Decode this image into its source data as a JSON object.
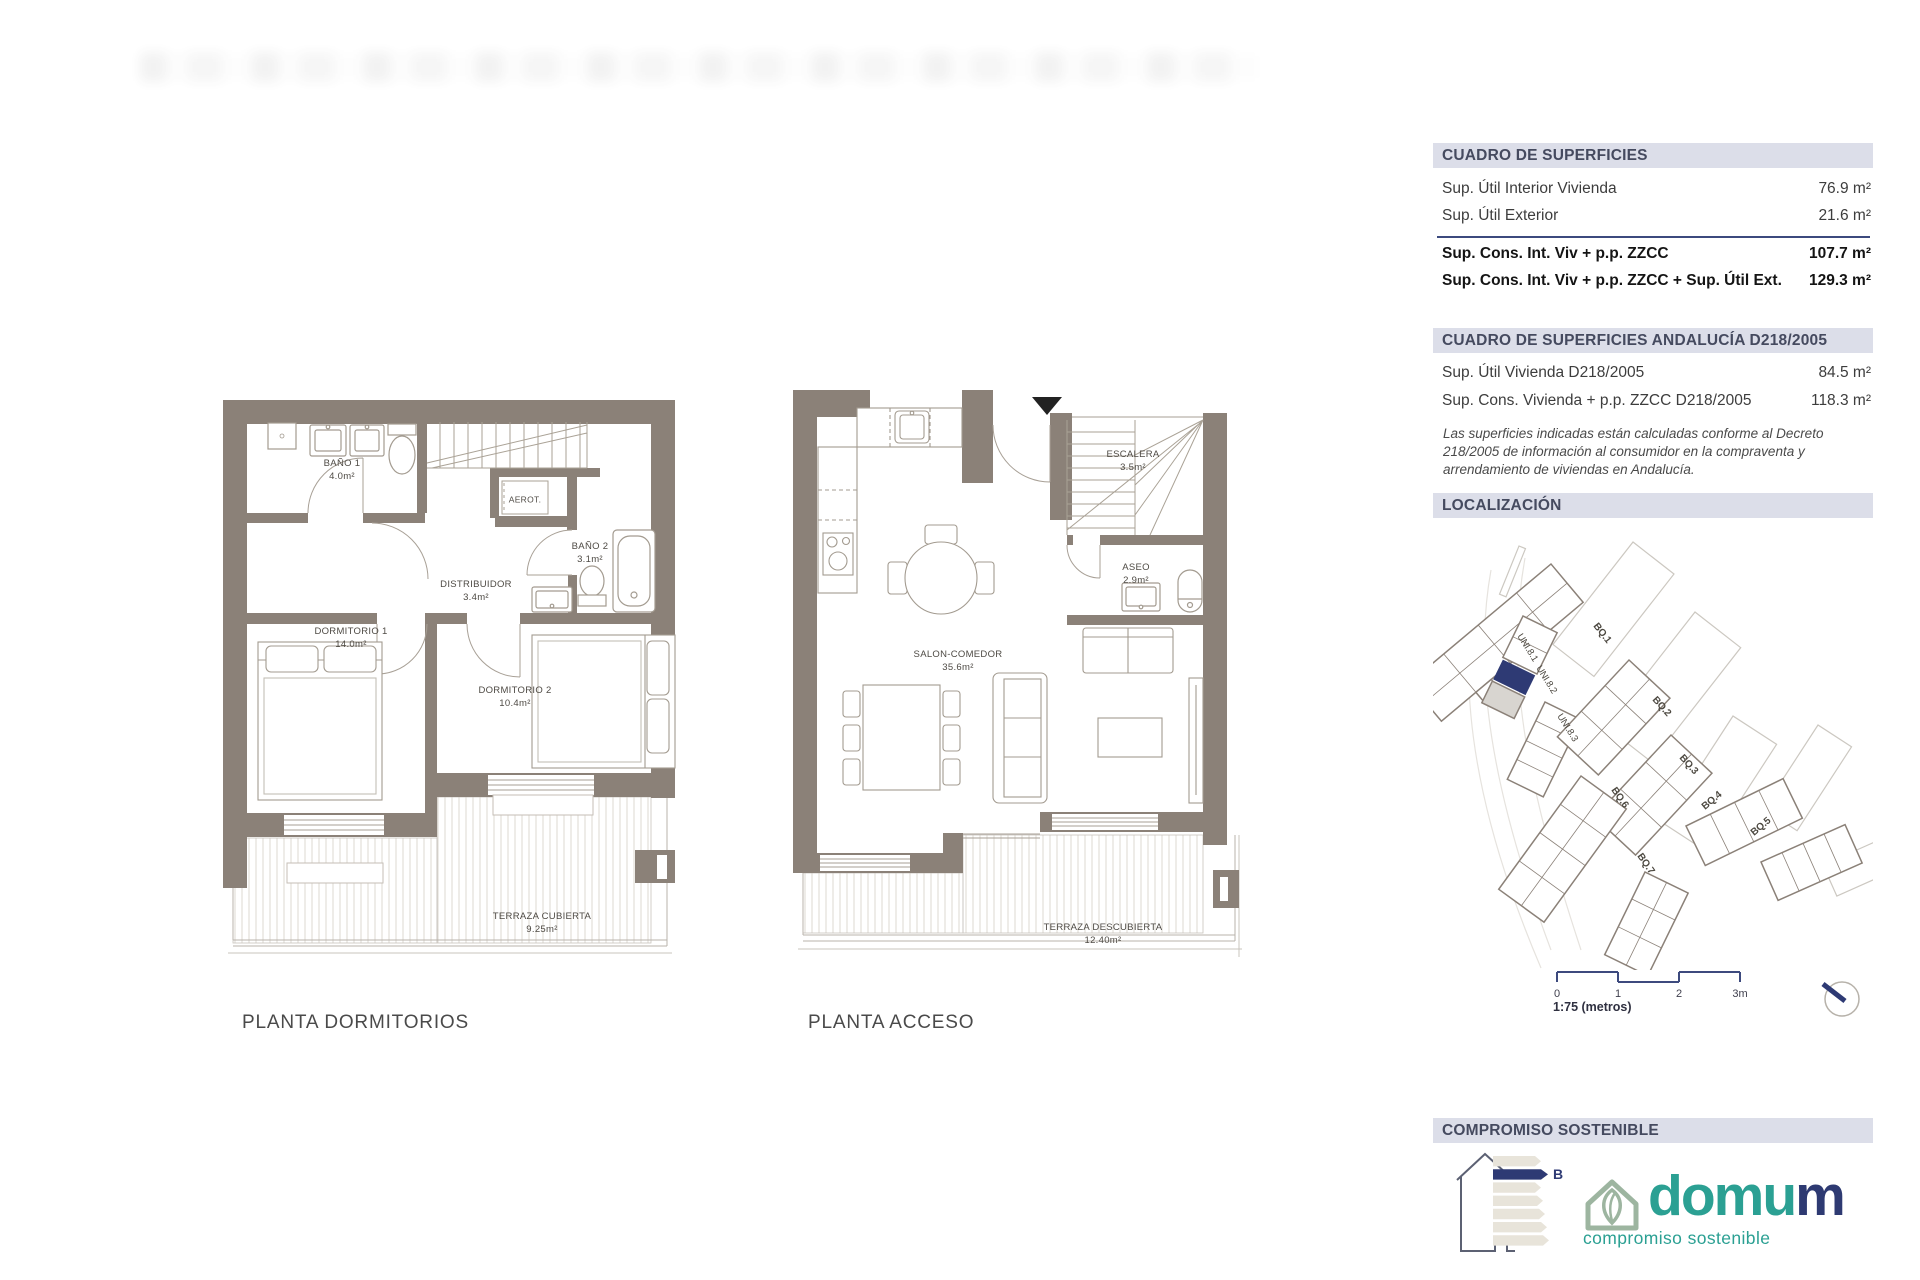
{
  "surfaces_table": {
    "title": "CUADRO DE SUPERFICIES",
    "rows": [
      {
        "label": "Sup. Útil Interior Vivienda",
        "value": "76.9 m²"
      },
      {
        "label": "Sup. Útil Exterior",
        "value": "21.6 m²"
      }
    ],
    "totals": [
      {
        "label": "Sup. Cons. Int. Viv + p.p. ZZCC",
        "value": "107.7 m²"
      },
      {
        "label": "Sup. Cons. Int. Viv + p.p. ZZCC + Sup. Útil Ext.",
        "value": "129.3 m²"
      }
    ]
  },
  "andalucia_table": {
    "title": "CUADRO DE SUPERFICIES ANDALUCÍA D218/2005",
    "rows": [
      {
        "label": "Sup. Útil Vivienda D218/2005",
        "value": "84.5 m²"
      },
      {
        "label": "Sup. Cons. Vivienda + p.p. ZZCC D218/2005",
        "value": "118.3 m²"
      }
    ],
    "note": "Las superficies indicadas están calculadas conforme al Decreto 218/2005 de información al consumidor en la compraventa y arrendamiento de viviendas en Andalucía."
  },
  "localization": {
    "title": "LOCALIZACIÓN",
    "labels": [
      {
        "text": "UNI.8.1"
      },
      {
        "text": "UNI.8.2"
      },
      {
        "text": "UNI.8.3"
      },
      {
        "text": "BQ.1"
      },
      {
        "text": "BQ.2"
      },
      {
        "text": "BQ.3"
      },
      {
        "text": "BQ.4"
      },
      {
        "text": "BQ.5"
      },
      {
        "text": "BQ.6"
      },
      {
        "text": "BQ.7"
      }
    ],
    "scale_ticks": [
      "0",
      "1",
      "2",
      "3m"
    ],
    "scale_caption": "1:75 (metros)"
  },
  "plans": {
    "dormitorios": {
      "title": "PLANTA DORMITORIOS",
      "rooms": {
        "bano1": {
          "name": "BAÑO 1",
          "area": "4.0m²"
        },
        "bano2": {
          "name": "BAÑO 2",
          "area": "3.1m²"
        },
        "distribuidor": {
          "name": "DISTRIBUIDOR",
          "area": "3.4m²"
        },
        "dormitorio1": {
          "name": "DORMITORIO 1",
          "area": "14.0m²"
        },
        "dormitorio2": {
          "name": "DORMITORIO 2",
          "area": "10.4m²"
        },
        "terraza": {
          "name": "TERRAZA CUBIERTA",
          "area": "9.25m²"
        },
        "aerot": {
          "name": "AEROT."
        }
      }
    },
    "acceso": {
      "title": "PLANTA ACCESO",
      "rooms": {
        "escalera": {
          "name": "ESCALERA",
          "area": "3.5m²"
        },
        "aseo": {
          "name": "ASEO",
          "area": "2.9m²"
        },
        "salon": {
          "name": "SALON-COMEDOR",
          "area": "35.6m²"
        },
        "terraza": {
          "name": "TERRAZA DESCUBIERTA",
          "area": "12.40m²"
        }
      }
    }
  },
  "footer": {
    "title": "COMPROMISO SOSTENIBLE",
    "energy_rating": "B",
    "brand_primary": "domu",
    "brand_suffix": "m",
    "brand_tagline": "compromiso sostenible"
  },
  "colors": {
    "wall": "#8b8178",
    "accent_navy": "#2e3a74",
    "header_bar": "#dcdee9",
    "header_text": "#454a5f",
    "teal": "#2ba093",
    "sage": "#9db5a0"
  }
}
